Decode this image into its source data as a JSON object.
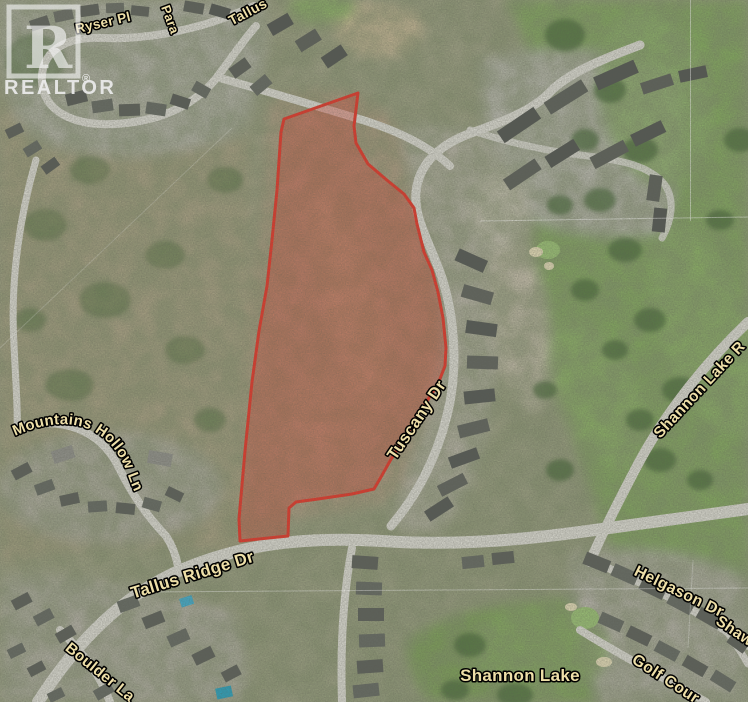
{
  "watermark": {
    "letter": "R",
    "brand": "REALTOR",
    "registered": "®"
  },
  "map": {
    "type": "satellite-aerial",
    "parcel": {
      "points": "358,93 354,126 356,143 368,164 388,181 404,194 414,208 417,224 424,252 432,270 438,292 443,318 446,348 445,366 438,384 425,404 406,436 390,461 381,477 374,489 352,494 318,499 296,502 289,508 288,536 240,541 239,519 245,451 252,382 259,331 267,286 272,240 277,190 281,132 284,119",
      "outline_color": "#e03a2c",
      "fill_color": "rgba(213,63,48,0.36)"
    },
    "colors": {
      "label_fill": "#eedfa8",
      "label_outline": "#000000",
      "golf_green": "#83a95f",
      "road": "#d5d5cc",
      "terrain_scrub": "#a39b7c",
      "housing_gray": "#b5b4a9",
      "tree_dark": "#4c6a3e",
      "pool_blue": "#3aa3c2"
    },
    "labels": [
      {
        "id": "ryser-pl",
        "kind": "road",
        "text": "Ryser Pl",
        "x": 104,
        "y": 27,
        "rotate": -13,
        "size": 13.5
      },
      {
        "id": "para",
        "kind": "road",
        "text": "Para",
        "x": 166,
        "y": 21,
        "rotate": 70,
        "size": 13
      },
      {
        "id": "tallus",
        "kind": "road",
        "text": "Tallus",
        "x": 250,
        "y": 16,
        "rotate": -28,
        "size": 14
      },
      {
        "id": "mountains-hollow-ln",
        "kind": "road",
        "text": "Mountains Hollow Ln",
        "path": "mhl-path",
        "size": 15
      },
      {
        "id": "tallus-ridge-dr",
        "kind": "road",
        "text": "Tallus Ridge Dr",
        "x": 194,
        "y": 580,
        "rotate": -17,
        "size": 17
      },
      {
        "id": "tuscany-dr",
        "kind": "road",
        "text": "Tuscany Dr",
        "x": 421,
        "y": 423,
        "rotate": -56,
        "size": 16.5
      },
      {
        "id": "shannon-lake-rd",
        "kind": "road",
        "text": "Shannon Lake R",
        "x": 703,
        "y": 393,
        "rotate": -47,
        "size": 15.5
      },
      {
        "id": "helgason-dr",
        "kind": "road",
        "text": "Helgason Dr",
        "x": 677,
        "y": 596,
        "rotate": 26,
        "size": 16
      },
      {
        "id": "shaw",
        "kind": "road",
        "text": "Shaw",
        "x": 732,
        "y": 635,
        "rotate": 34,
        "size": 15.5
      },
      {
        "id": "golf-course",
        "kind": "road",
        "text": "Golf Cour",
        "x": 663,
        "y": 683,
        "rotate": 33,
        "size": 16
      },
      {
        "id": "boulder-ln",
        "kind": "road",
        "text": "Boulder La",
        "x": 97,
        "y": 676,
        "rotate": 39,
        "size": 15.5
      },
      {
        "id": "shannon-lake",
        "kind": "place",
        "text": "Shannon Lake",
        "x": 520,
        "y": 681,
        "rotate": 0,
        "size": 17
      }
    ]
  }
}
